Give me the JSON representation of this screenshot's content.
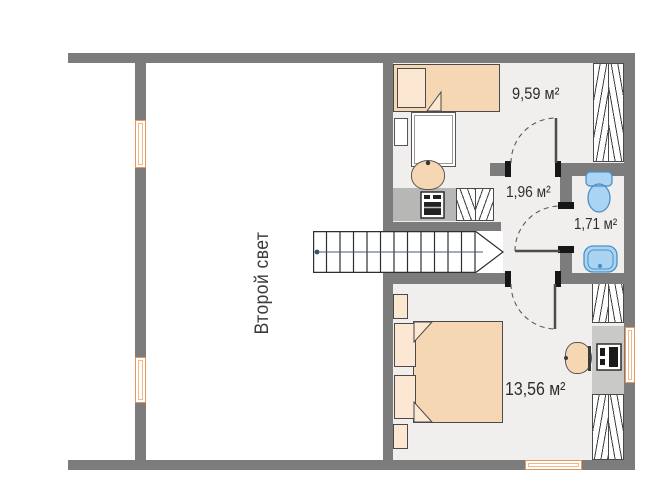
{
  "plan_title": "Второй этаж — план",
  "rooms": {
    "void": {
      "label": "Второй свет"
    },
    "bedroom_top": {
      "area_label": "9,59 м²"
    },
    "hall": {
      "area_label": "1,96 м²"
    },
    "bathroom": {
      "area_label": "1,71 м²"
    },
    "bedroom_bottom": {
      "area_label": "13,56 м²"
    }
  },
  "stairs": {
    "steps": 12,
    "tread_px": 13.5
  },
  "colors": {
    "wall": "#7c7c7c",
    "floor": "#f0efed",
    "furniture_tan": "#f6d7b4",
    "furniture_tan_light": "#fbe7d2",
    "fixture_blue": "#abd4f2",
    "fixture_blue_stroke": "#4a90c8",
    "window_frame_orange": "#e8975c",
    "outline_dark": "#4a4a4a"
  },
  "icons": {
    "toilet": "toilet-icon",
    "sink": "sink-icon",
    "oven": "oven-icon",
    "monitor": "monitor-icon",
    "stairs": "stairs-icon",
    "door_swing": "door-swing-arc"
  }
}
